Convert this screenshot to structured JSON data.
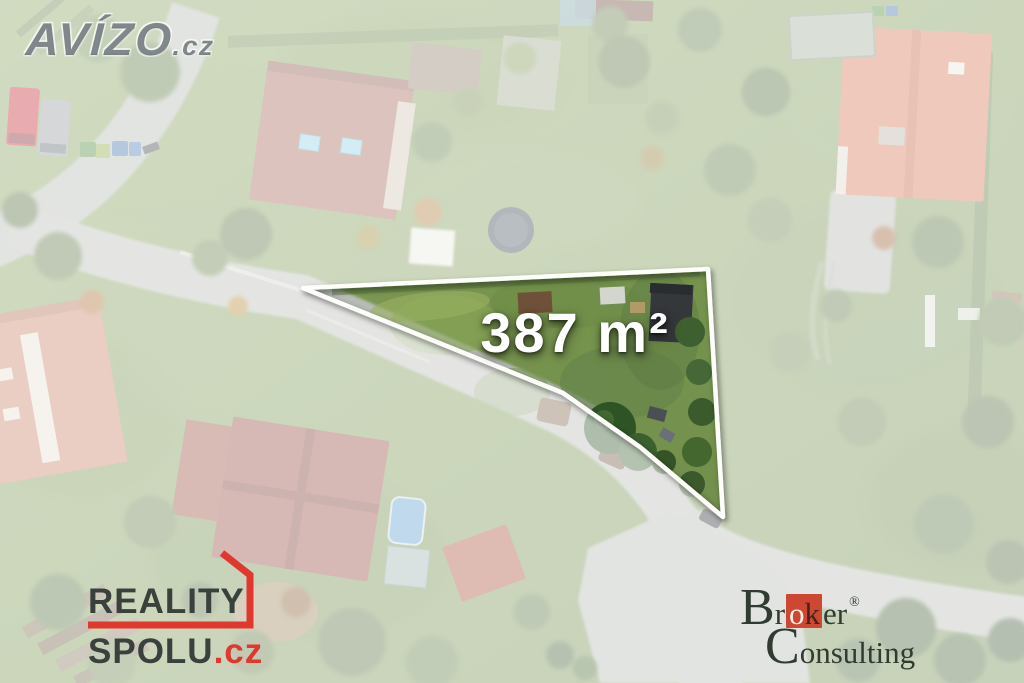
{
  "watermark": {
    "brand": "AVÍZO",
    "tld": ".cz"
  },
  "plot": {
    "area": "387 m²"
  },
  "logos": {
    "reality": {
      "word1": "REALITY",
      "word2": "SPOLU",
      "tld": ".cz"
    },
    "broker": {
      "b": "B",
      "r": "r",
      "o": "o",
      "k": "k",
      "er": "er",
      "reg": "®",
      "c": "C",
      "onsulting": "onsulting"
    }
  },
  "palette": {
    "reality_red": "#e0382e",
    "broker_red": "#cd4732",
    "plot_outline": "#ffffff",
    "area_text": "#ffffff",
    "grass_green": "#7a9a52",
    "road_gray": "#b8bcb6",
    "fade_overlay": "rgba(255,255,255,0.62)"
  }
}
